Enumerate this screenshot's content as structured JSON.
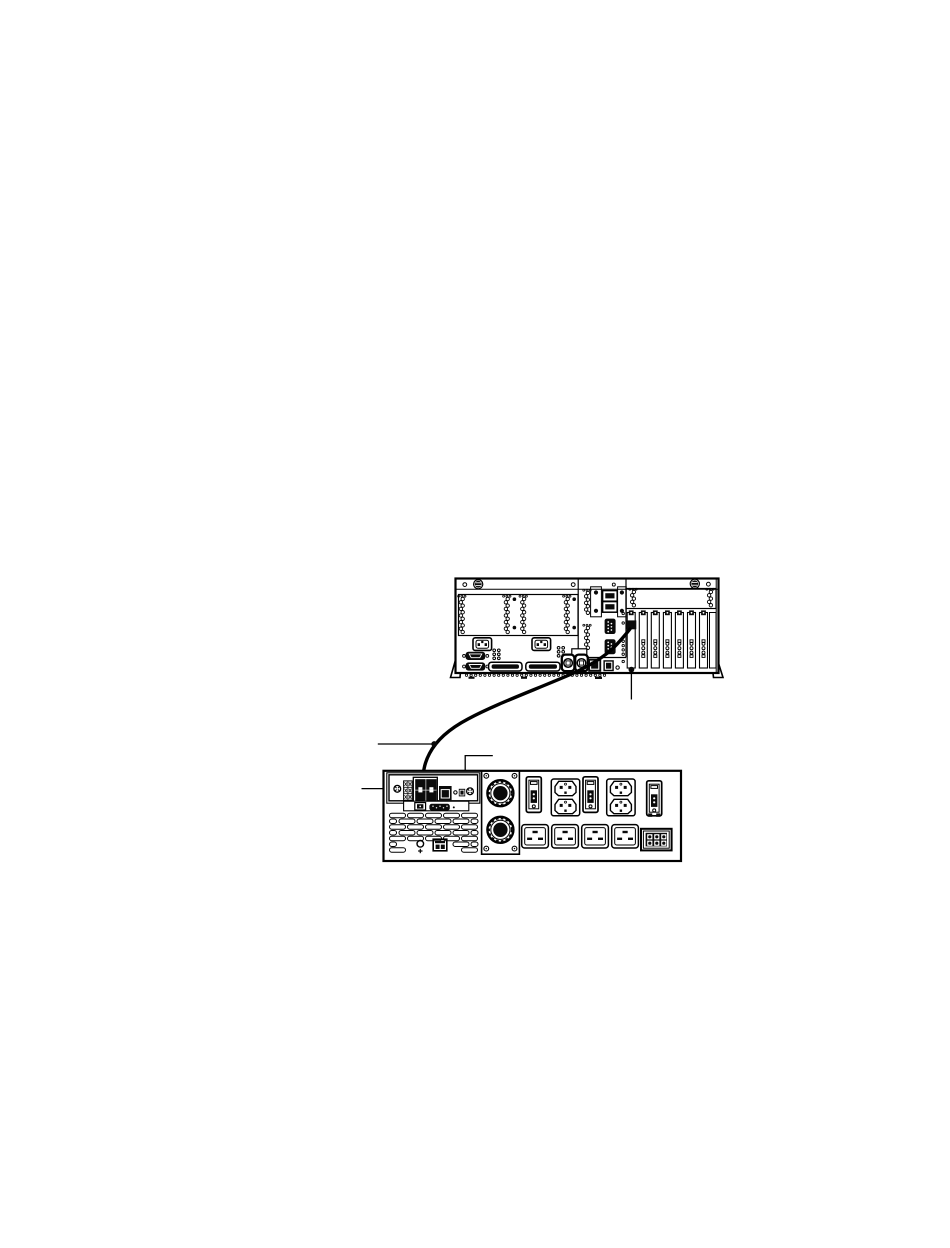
{
  "figure": {
    "kind": "hardware-cabling-diagram",
    "colors": {
      "line": "#000000",
      "ink": "#0a0a0a",
      "background": "#ffffff"
    }
  },
  "server": {
    "id": "server-rear-panel",
    "pci_slot_count": 7,
    "slot_chain_slots": 6,
    "psu_coil_count": 4,
    "bay_coil_count": 2,
    "io_panel_coil_count": 2,
    "power_inlet_count": 2,
    "serial_port_count": 2,
    "scsi_connector_count": 2,
    "bottom_vent_hole_count": 31,
    "adapter_port_slot": 1
  },
  "pdu": {
    "id": "power-subsystem-rear-panel",
    "rj45_quad_jack_count": 4,
    "single_rj45_count": 1,
    "circuit_breaker_count": 3,
    "c13_outlet_pair_count": 2,
    "c19_outlet_count": 4,
    "input_connector_count": 2,
    "vent_row_count": 7,
    "input_panel_screw_count": 4,
    "multipin_cell_count": 6
  },
  "connection": {
    "cable_from": "server-adapter-port",
    "cable_to": "pdu-rj45-quad-block"
  },
  "callouts": [
    {
      "id": "cable-callout",
      "style": "line-with-dot"
    },
    {
      "id": "panel-callout",
      "style": "elbow-line-with-dot"
    },
    {
      "id": "screw-callout",
      "style": "line"
    },
    {
      "id": "adapter-port-callout",
      "style": "vertical-line-with-dot"
    }
  ]
}
